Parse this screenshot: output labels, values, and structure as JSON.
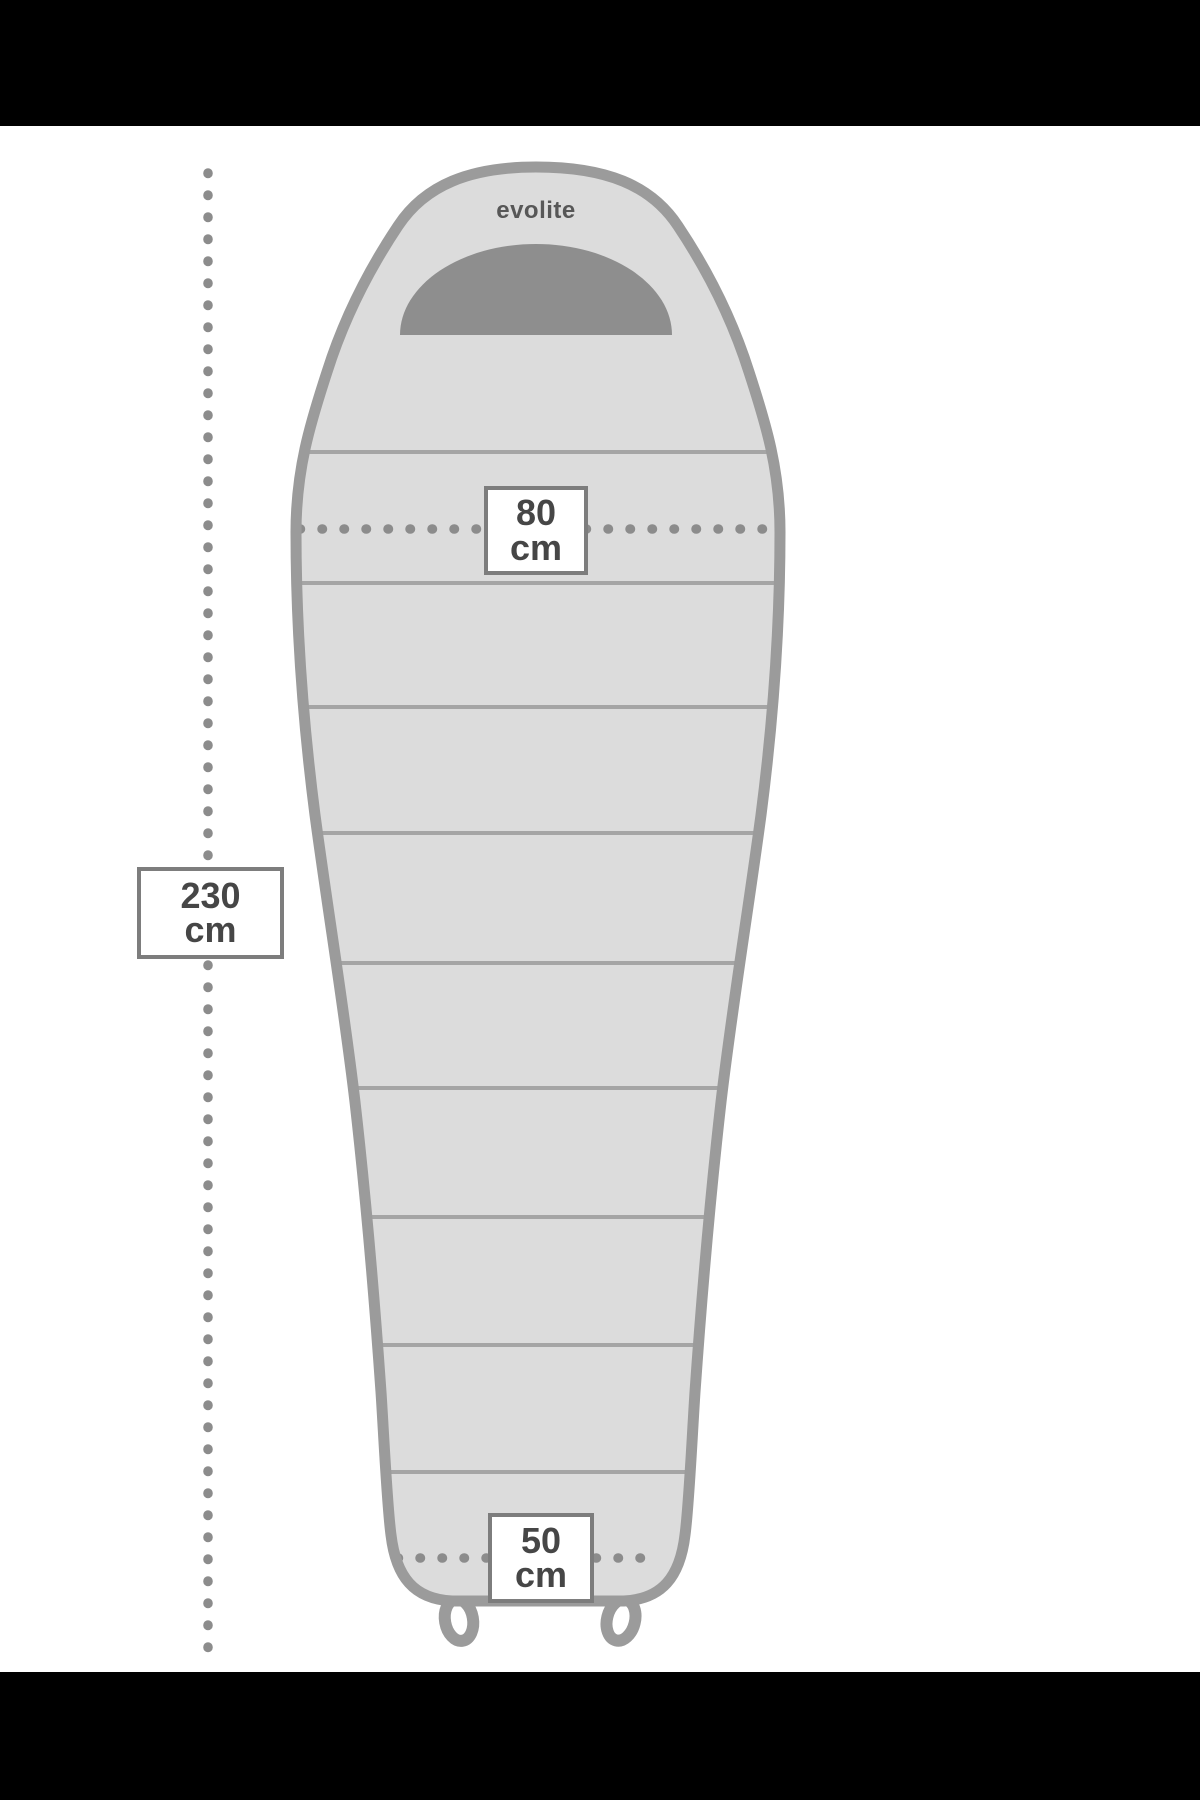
{
  "page": {
    "background": "#ffffff",
    "letterbox_color": "#000000"
  },
  "diagram": {
    "type": "sleeping-bag-dimension-diagram",
    "brand": "evolite",
    "dimensions": {
      "top_width": {
        "value": "80",
        "unit": "cm"
      },
      "total_length": {
        "value": "230",
        "unit": "cm"
      },
      "bottom_width": {
        "value": "50",
        "unit": "cm"
      }
    },
    "colors": {
      "bag_fill": "#dcdcdc",
      "bag_outline": "#9b9b9b",
      "hood_fill": "#8e8e8e",
      "seam_line": "#a5a5a5",
      "dotted_line": "#8c8c8c",
      "label_text": "#464646",
      "label_border": "#7d7d7d",
      "brand_text": "#575757"
    }
  }
}
